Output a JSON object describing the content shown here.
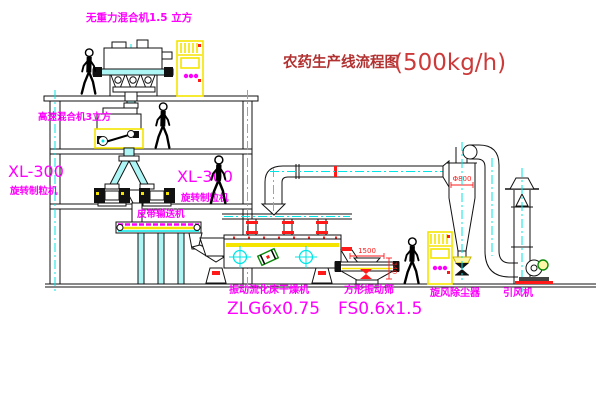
{
  "title": {
    "main": "农药生产线流程图",
    "capacity": "(500kg/h)"
  },
  "equipment": {
    "gravity_mixer": {
      "label": "无重力混合机1.5 立方"
    },
    "high_speed_mixer": {
      "label": "高速混合机3立方"
    },
    "granulator_wall": {
      "model": "XL-300",
      "name": "旋转制粒机"
    },
    "granulator": {
      "model": "XL-300",
      "name": "旋转制粒机"
    },
    "belt_conveyor": {
      "name": "皮带输送机"
    },
    "fluid_bed_dryer": {
      "name": "振动流化床干燥机",
      "model": "ZLG6x0.75"
    },
    "square_sieve": {
      "name": "方形振动筛",
      "model": "FS0.6x1.5"
    },
    "cyclone": {
      "name": "旋风除尘器"
    },
    "draft_fan": {
      "name": "引风机"
    }
  },
  "dimensions": {
    "sieve_feed_width": "1500",
    "sieve_height": "340",
    "cyclone_diameter": "Φ800"
  },
  "symbols": {
    "worker-figure": "walking person silhouette",
    "control-cabinet": "yellow electric control cabinet with magenta knobs",
    "center-line": "cyan dash-dot CAD centerline",
    "crosshair-mark": "cyan circle with cross (axis target)"
  },
  "colors": {
    "label_magenta": "#ff00ff",
    "centerline_cyan": "#00e5e5",
    "highlight_yellow": "#f5e400",
    "dimension_red": "#ff1a1a",
    "title_red": "#b23232",
    "line_black": "#111111",
    "background": "#ffffff"
  }
}
